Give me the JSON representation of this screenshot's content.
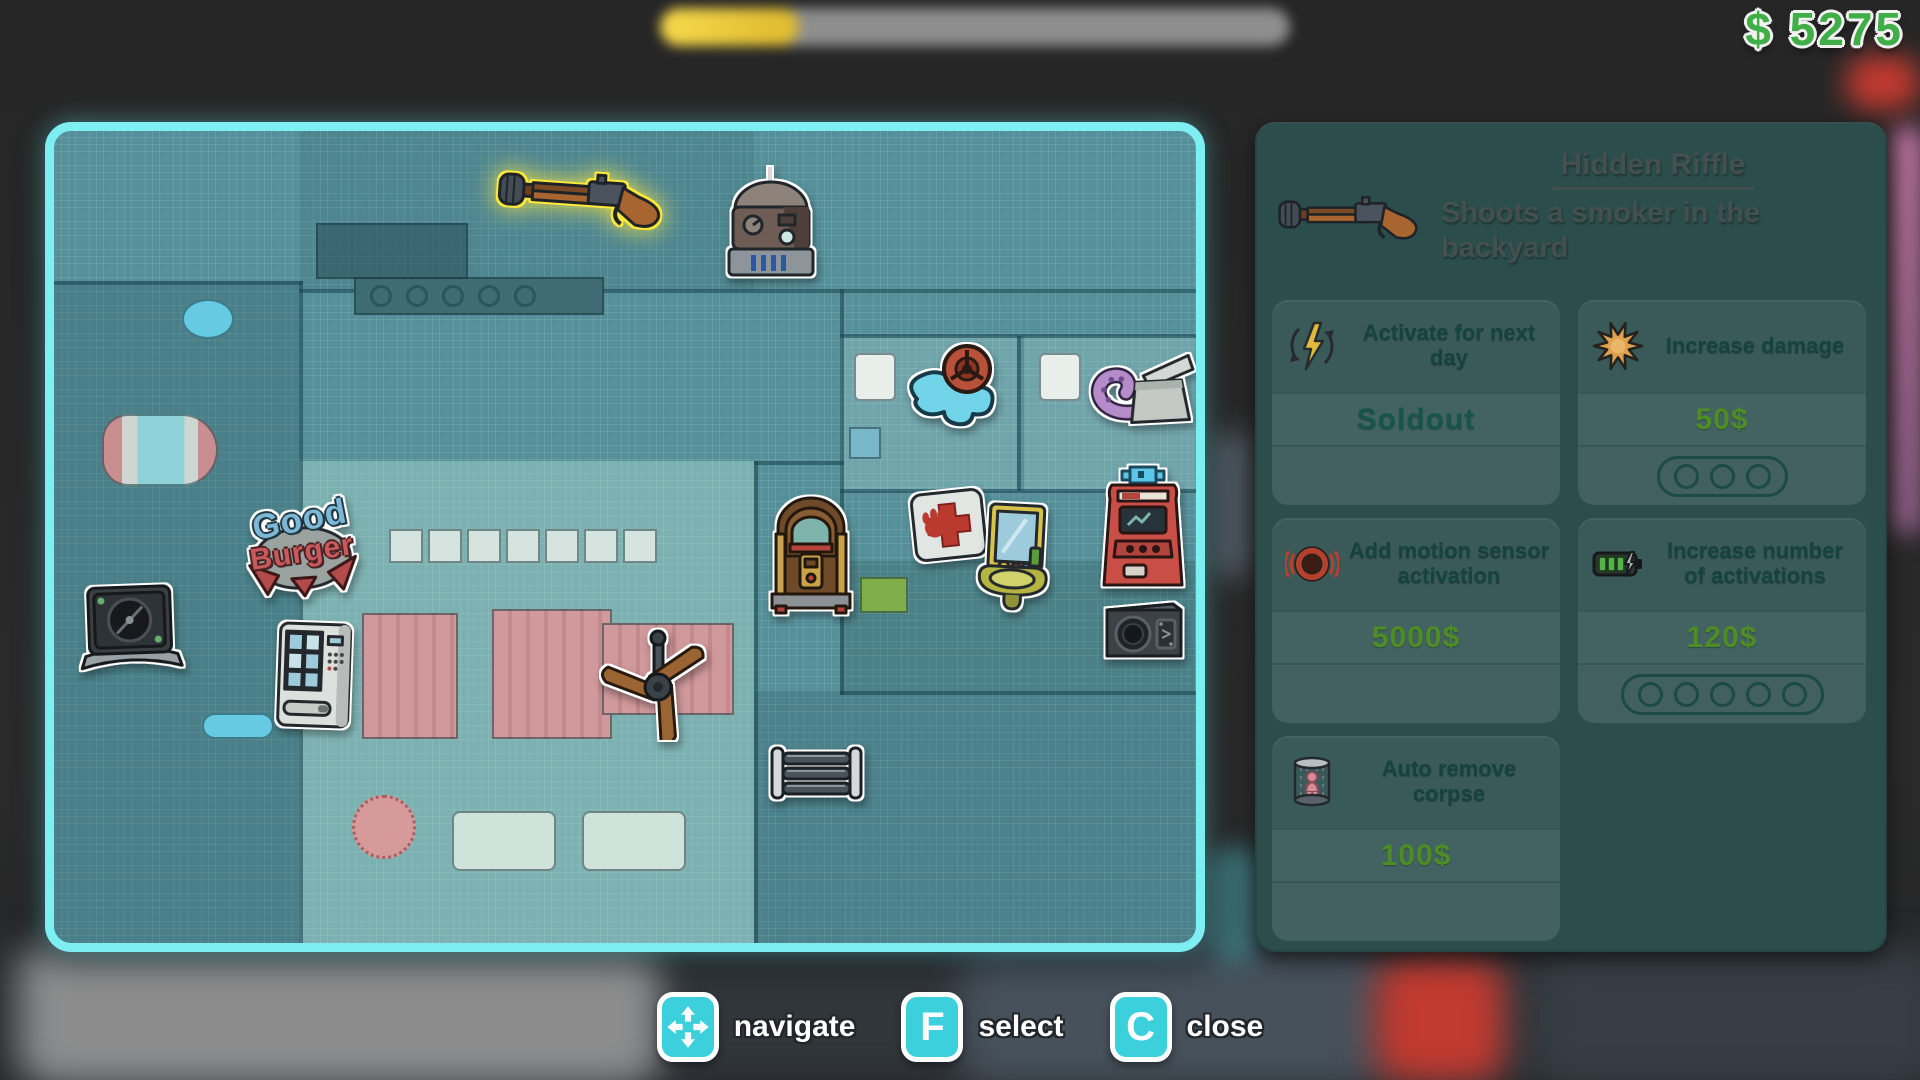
{
  "hud": {
    "money": "$ 5275",
    "progress_pct": 22
  },
  "detail_panel": {
    "title": "Hidden Riffle",
    "description": "Shoots a smoker in the backyard",
    "item_icon": "rifle-icon",
    "upgrades": [
      {
        "icon": "recharge-lightning-icon",
        "label": "Activate for next day",
        "price": "Soldout",
        "sold_out": true,
        "pips": 0
      },
      {
        "icon": "damage-burst-icon",
        "label": "Increase damage",
        "price": "50$",
        "sold_out": false,
        "pips": 3
      },
      {
        "icon": "motion-sensor-icon",
        "label": "Add motion sensor activation",
        "price": "5000$",
        "sold_out": false,
        "pips": 0
      },
      {
        "icon": "battery-icon",
        "label": "Increase number of activations",
        "price": "120$",
        "sold_out": false,
        "pips": 5
      },
      {
        "icon": "acid-shower-icon",
        "label": "Auto remove corpse",
        "price": "100$",
        "sold_out": false,
        "pips": 0
      }
    ]
  },
  "controls": [
    {
      "icon": "dpad-arrows-icon",
      "key": "",
      "label": "navigate"
    },
    {
      "icon": "",
      "key": "F",
      "label": "select"
    },
    {
      "icon": "",
      "key": "C",
      "label": "close"
    }
  ],
  "map": {
    "selected_item": "Hidden Riffle",
    "logo_line1": "Good",
    "logo_line2": "Burger",
    "stickers": [
      "hidden-riffle",
      "robot",
      "water-puddle-valve",
      "octopus-box",
      "jukebox",
      "medkit",
      "sink-mirror",
      "arcade-machine",
      "speaker-box",
      "safe",
      "vending-machine",
      "good-burger-logo",
      "ceiling-fan",
      "radiator"
    ]
  },
  "colors": {
    "money_green": "#3fae47",
    "key_cyan": "#3bd0dc",
    "map_border_cyan": "#7deef2",
    "panel_bg": "#2b4e4d",
    "price_green": "#4e8c26",
    "selected_outline_yellow": "#ffe93a"
  }
}
